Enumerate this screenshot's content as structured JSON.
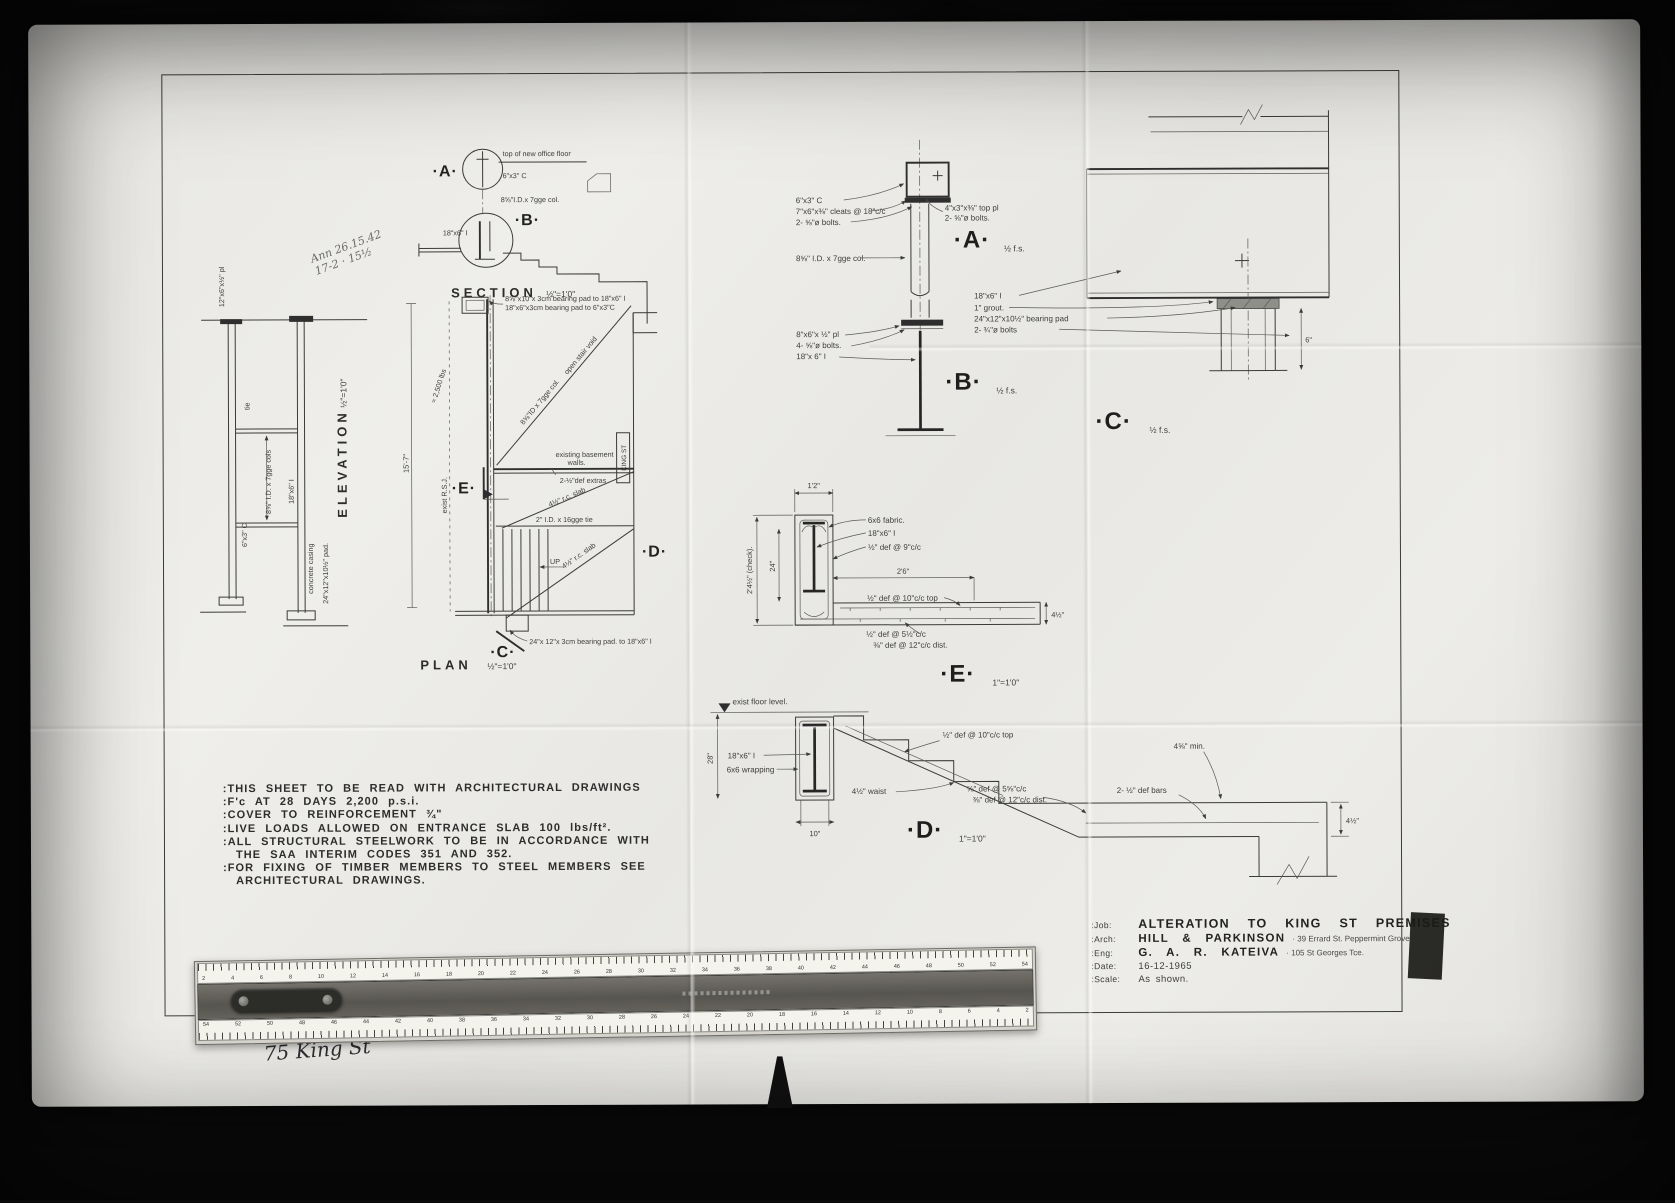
{
  "handwriting": {
    "top_line1": "Ann 26.15.42",
    "top_line2": "17-2 · 15½",
    "bottom_note": "75 King St"
  },
  "views": {
    "section": {
      "title": "SECTION",
      "scale": "½\"=1'0\"",
      "floor_note": "top of new office floor",
      "channel": "6\"x3\" C",
      "column": "8⅝\"I.D.x 7gge col.",
      "beam": "18\"x6\" I",
      "marker_a": "·A·",
      "marker_b": "·B·"
    },
    "elevation": {
      "title": "ELEVATION",
      "scale": "½\"=1'0\"",
      "plate": "12\"x6\"x½\" pl",
      "tie": "tie",
      "channel": "6\"x3\" C",
      "columns": "8⅝\" I.D. x 7gge cols",
      "beam": "18\"x6\" I",
      "casing": "concrete casing",
      "pad": "24\"x12\"x10½\" pad."
    },
    "plan": {
      "title": "PLAN",
      "scale": "½\"=1'0\"",
      "bearing_pad_top1": "8⅝\"x10\"x 3cm bearing pad to 18\"x6\" I",
      "bearing_pad_top2": "18\"x6\"x3cm bearing pad to 6\"x3\"C",
      "existing_walls1": "existing basement",
      "existing_walls2": "walls.",
      "def_extras": "2-½\"def extras",
      "rc_slab": "4½\" r.c. slab",
      "open_void": "open stair void",
      "column": "8⅝\"ID x 7gge col.",
      "tie": "2\" I.D. x 16gge tie",
      "up": "UP",
      "exist_rsj": "exist R.S.J.",
      "load": "≈ 2,500 lbs",
      "dim": "15'-7\"",
      "bearing_pad_bottom": "24\"x 12\"x 3cm bearing pad. to 18\"x6\" I",
      "king_st": "KING ST",
      "marker_c": "·C·",
      "marker_d": "·D·",
      "marker_e": "·E·"
    },
    "detail_a": {
      "marker": "·A·",
      "scale": "½ f.s.",
      "channel": "6\"x3\" C",
      "cleats": "7\"x6\"x⅜\" cleats @ 18\"c/c",
      "bolts_left": "2- ⅝\"ø bolts.",
      "column": "8⅝\" I.D. x 7gge col.",
      "top_plate": "4\"x3\"x⅜\" top pl",
      "bolts_right": "2- ⅝\"ø bolts."
    },
    "detail_b": {
      "marker": "·B·",
      "scale": "½ f.s.",
      "plate": "8\"x6\"x ½\" pl",
      "bolts": "4- ⅝\"ø bolts.",
      "beam": "18\"x 6\" I"
    },
    "detail_c": {
      "marker": "·C·",
      "scale": "½ f.s.",
      "beam": "18\"x6\" I",
      "grout": "1\" grout.",
      "pad": "24\"x12\"x10½\" bearing pad",
      "bolts": "2- ¾\"ø bolts",
      "dim": "6\""
    },
    "detail_e": {
      "marker": "·E·",
      "scale": "1\"=1'0\"",
      "dim_top": "1'2\"",
      "dim_left": "2'4½\" (check).",
      "dim_inner": "24\"",
      "fabric": "6x6 fabric.",
      "beam": "18\"x6\" I",
      "bars_side": "½\" def @ 9\"c/c",
      "dim_span": "2'6\"",
      "bars_top": "½\" def @ 10\"c/c top",
      "bars_bottom": "½\" def @ 5½\"c/c",
      "bars_dist": "⅜\" def @ 12\"c/c dist.",
      "dim_slab": "4½\""
    },
    "detail_d": {
      "marker": "·D·",
      "scale": "1\"=1'0\"",
      "floor_note": "exist floor level.",
      "dim_left": "28\"",
      "beam": "18\"x6\" I",
      "wrapping": "6x6 wrapping",
      "bars_top": "½\" def @ 10\"c/c top",
      "waist": "4½\" waist",
      "dim_base": "10\"",
      "bars_bottom": "⅝\" def @ 5⅝\"c/c",
      "bars_dist": "⅜\" def @ 12\"c/c dist.",
      "def_bars": "2- ½\" def bars",
      "min_dim": "4⅝\" min.",
      "dim_slab": "4½\""
    }
  },
  "notes": {
    "lines": [
      ":THIS SHEET TO BE READ WITH ARCHITECTURAL DRAWINGS",
      ":F'c AT 28 DAYS 2,200 p.s.i.",
      ":COVER TO REINFORCEMENT ¾\"",
      ":LIVE LOADS ALLOWED ON ENTRANCE SLAB 100 lbs/ft².",
      ":ALL STRUCTURAL STEELWORK TO BE IN ACCORDANCE WITH",
      "THE SAA INTERIM CODES 351 AND 352.",
      ":FOR FIXING OF TIMBER MEMBERS TO STEEL MEMBERS SEE",
      "ARCHITECTURAL DRAWINGS."
    ]
  },
  "title_block": {
    "rows": [
      {
        "label": ":Job:",
        "value": "ALTERATION TO KING ST PREMISES",
        "extra": ""
      },
      {
        "label": ":Arch:",
        "value": "HILL & PARKINSON",
        "extra": "· 39 Errard St. Peppermint Grove"
      },
      {
        "label": ":Eng:",
        "value": "G. A. R. KATEIVA",
        "extra": "· 105 St Georges Tce."
      },
      {
        "label": ":Date:",
        "value": "16-12-1965",
        "extra": ""
      },
      {
        "label": ":Scale:",
        "value": "As shown.",
        "extra": ""
      }
    ]
  },
  "ruler": {
    "top_numbers": [
      "2",
      "4",
      "6",
      "8",
      "10",
      "12",
      "14",
      "16",
      "18",
      "20",
      "22",
      "24",
      "26",
      "28",
      "30",
      "32",
      "34",
      "36",
      "38",
      "40",
      "42",
      "44",
      "46",
      "48",
      "50",
      "52",
      "54"
    ],
    "bottom_numbers": [
      "54",
      "52",
      "50",
      "48",
      "46",
      "44",
      "42",
      "40",
      "38",
      "36",
      "34",
      "32",
      "30",
      "28",
      "26",
      "24",
      "22",
      "20",
      "18",
      "16",
      "14",
      "12",
      "10",
      "8",
      "6",
      "4",
      "2"
    ]
  }
}
